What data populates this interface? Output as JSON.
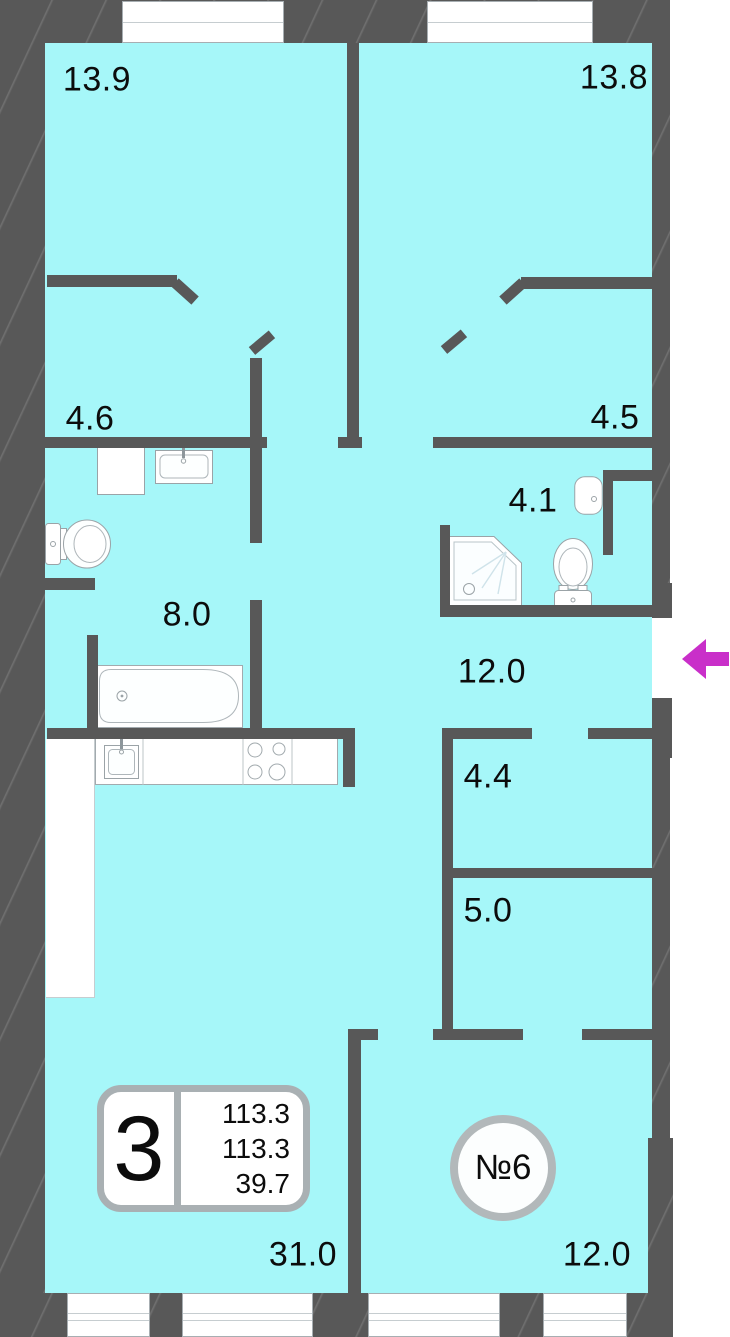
{
  "plan": {
    "type": "apartment-floor-plan",
    "room_labels": [
      {
        "id": "bedroom-left",
        "text": "13.9"
      },
      {
        "id": "bedroom-right",
        "text": "13.8"
      },
      {
        "id": "bath-left",
        "text": "4.6"
      },
      {
        "id": "room-mid-right",
        "text": "4.5"
      },
      {
        "id": "wc-right",
        "text": "4.1"
      },
      {
        "id": "bath-kitchen",
        "text": "8.0"
      },
      {
        "id": "hallway",
        "text": "12.0"
      },
      {
        "id": "storage-upper",
        "text": "4.4"
      },
      {
        "id": "storage-lower",
        "text": "5.0"
      },
      {
        "id": "living-room",
        "text": "31.0"
      },
      {
        "id": "room-bottom-right",
        "text": "12.0"
      }
    ],
    "badge": {
      "number": "3",
      "lines": [
        "113.3",
        "113.3",
        "39.7"
      ]
    },
    "unit_circle": {
      "label": "№6"
    },
    "entrance_arrow": {
      "direction": "left",
      "color": "#c92fc9"
    },
    "fixtures": [
      {
        "name": "washing-machine",
        "room": "4.6"
      },
      {
        "name": "wash-basin",
        "room": "4.6"
      },
      {
        "name": "toilet",
        "room": "4.6"
      },
      {
        "name": "bathtub",
        "room": "8.0"
      },
      {
        "name": "kitchen-sink",
        "room": "8.0"
      },
      {
        "name": "stove",
        "room": "8.0"
      },
      {
        "name": "shower-tray",
        "room": "4.1"
      },
      {
        "name": "wash-basin",
        "room": "4.1"
      },
      {
        "name": "toilet",
        "room": "4.1"
      }
    ],
    "colors": {
      "floor": "#a6f7f9",
      "wall": "#585858",
      "fixture_outline": "#9ba3a7",
      "arrow": "#c92fc9"
    }
  }
}
